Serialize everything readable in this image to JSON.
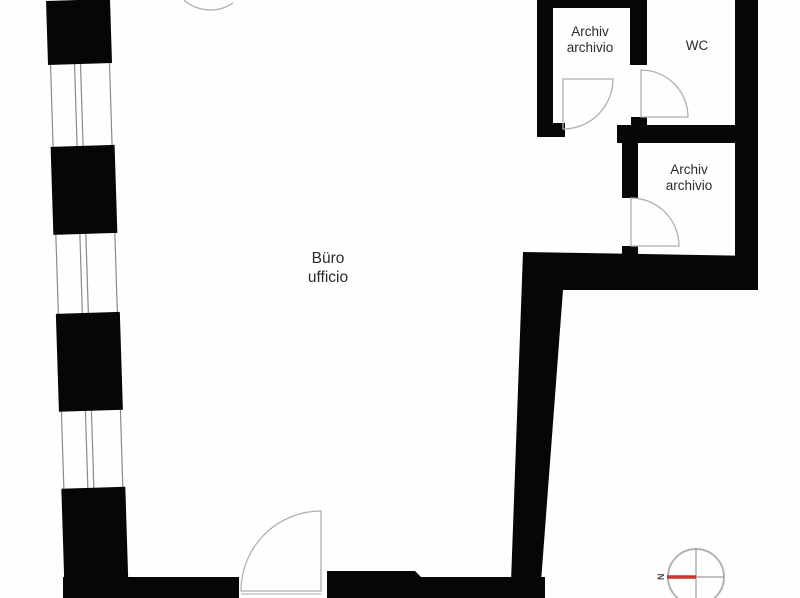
{
  "plan": {
    "type": "architectural-floor-plan",
    "style": "black-wall poché plan with window bands and door swing arcs"
  },
  "rooms": [
    {
      "id": "buero",
      "line1": "Büro",
      "line2": "ufficio"
    },
    {
      "id": "archiv-upper",
      "line1": "Archiv",
      "line2": "archivio"
    },
    {
      "id": "wc",
      "line1": "WC",
      "line2": ""
    },
    {
      "id": "archiv-mid",
      "line1": "Archiv",
      "line2": "archivio"
    }
  ],
  "compass": {
    "north_label": "N",
    "needle_color": "#c8372d",
    "ring_color": "#b3b3b3",
    "orientation": "north-pointing-left"
  },
  "colors": {
    "wall": "#060606",
    "window_line": "#8a8a8a",
    "door_arc": "#b0b0b0",
    "label_text": "#2b2b2b",
    "background": "#fefefe"
  }
}
